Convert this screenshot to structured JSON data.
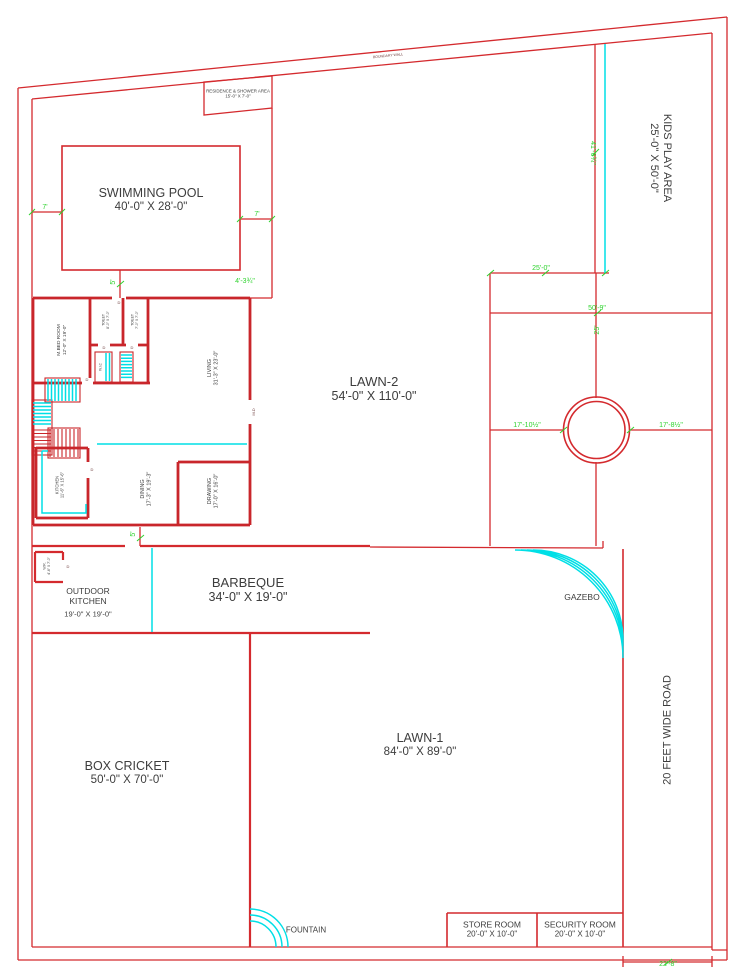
{
  "plan": {
    "boundary_note": "BOUNDARY WALL",
    "road": {
      "label": "20 FEET WIDE ROAD"
    },
    "rooms": {
      "residence": {
        "name": "RESIDENCE & SHOWER AREA",
        "dims": "15'-0\" X 7'-0\""
      },
      "pool": {
        "name": "SWIMMING POOL",
        "dims": "40'-0\" X 28'-0\""
      },
      "kids_play": {
        "name": "KIDS PLAY AREA",
        "dims": "25'-0\" X 50'-0\""
      },
      "lawn2": {
        "name": "LAWN-2",
        "dims": "54'-0\" X 110'-0\""
      },
      "lawn1": {
        "name": "LAWN-1",
        "dims": "84'-0\" X 89'-0\""
      },
      "box_cricket": {
        "name": "BOX CRICKET",
        "dims": "50'-0\" X 70'-0\""
      },
      "barbeque": {
        "name": "BARBEQUE",
        "dims": "34'-0\" X 19'-0\""
      },
      "outdoor_kitchen": {
        "name": "OUTDOOR KITCHEN",
        "dims": "19'-0\" X 19'-0\""
      },
      "gazebo": {
        "name": "GAZEBO"
      },
      "fountain": {
        "name": "FOUNTAIN"
      },
      "store": {
        "name": "STORE ROOM",
        "dims": "20'-0\" X 10'-0\""
      },
      "security": {
        "name": "SECURITY ROOM",
        "dims": "20'-0\" X 10'-0\""
      },
      "m_bedroom": {
        "name": "M.BED ROOM",
        "dims": "12'-0\" X 19'-0\""
      },
      "toilet1": {
        "name": "TOILET",
        "dims": "8'-0\" X 7'-0\""
      },
      "toilet2": {
        "name": "TOILET",
        "dims": "7'-0\" X 7'-0\""
      },
      "wic": {
        "name": "W.I.C"
      },
      "living": {
        "name": "LIVING",
        "dims": "31'-3\" X 23'-0\""
      },
      "kitchen": {
        "name": "KITCHEN",
        "dims": "11'-6\" X 15'-6\""
      },
      "dining": {
        "name": "DINING",
        "dims": "17'-3\" X 19'-3\""
      },
      "drawing": {
        "name": "DRAWING",
        "dims": "17'-0\" X 16'-0\""
      },
      "wr": {
        "name": "W.R.",
        "dims": "4'-6\" X 7'-0\""
      }
    },
    "doors": {
      "door": "D",
      "main_door": "M.D"
    },
    "dims": {
      "pool_left": "7'",
      "pool_right": "7'",
      "pool_bottom": "5'",
      "pool_offset": "4'-3¾\"",
      "house_opening": "5'",
      "kids_height": "41'-6¾\"",
      "kids_width": "25'-0\"",
      "cross_width": "50'-9\"",
      "cross_offset": "25'",
      "circle_left": "17'-10½\"",
      "circle_right": "17'-8½\"",
      "plot_bottom": "22'-8\""
    },
    "colors": {
      "wall": "#d42a2e",
      "accent": "#00dfe6",
      "dimension": "#2ed32e",
      "text": "#3d3d3d"
    }
  }
}
